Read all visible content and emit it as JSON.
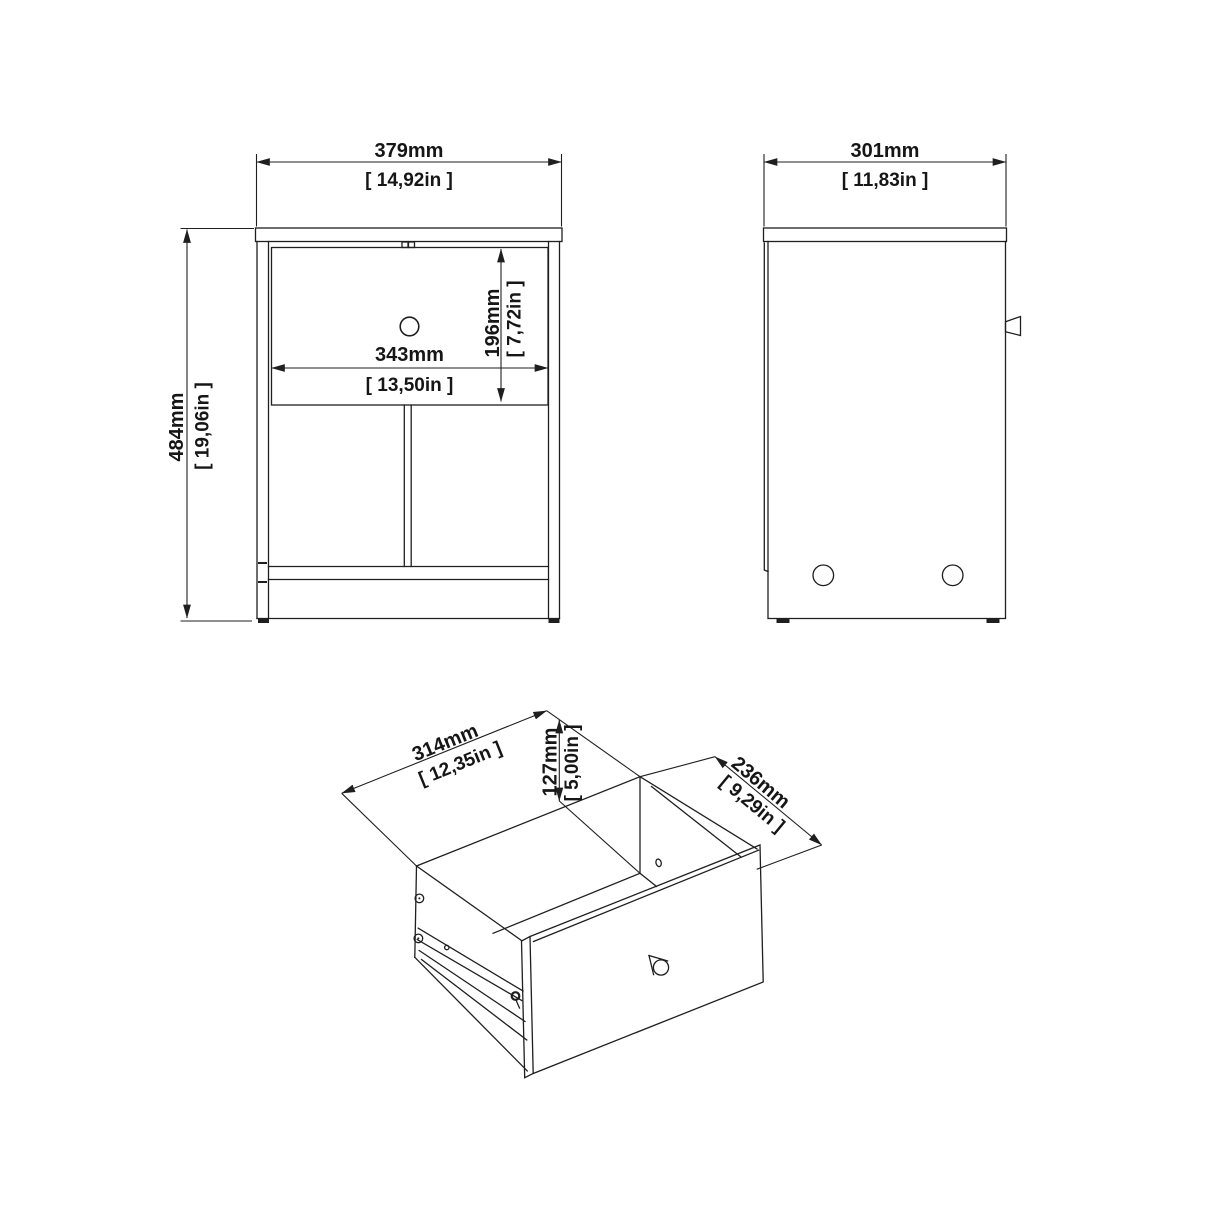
{
  "page": {
    "background": "#ffffff",
    "line_color": "#1f1f1f",
    "drawing_title": "Nightstand technical drawing with front view, side view and drawer isometric view"
  },
  "front_view": {
    "width_mm": "379mm",
    "width_in": "[ 14,92in ]",
    "height_mm": "484mm",
    "height_in": "[ 19,06in ]",
    "drawer_width_mm": "343mm",
    "drawer_width_in": "[ 13,50in ]",
    "drawer_height_mm": "196mm",
    "drawer_height_in": "[ 7,72in ]"
  },
  "side_view": {
    "depth_mm": "301mm",
    "depth_in": "[ 11,83in ]"
  },
  "drawer_view": {
    "width_mm": "314mm",
    "width_in": "[ 12,35in ]",
    "height_mm": "127mm",
    "height_in": "[ 5,00in ]",
    "depth_mm": "236mm",
    "depth_in": "[ 9,29in ]"
  }
}
